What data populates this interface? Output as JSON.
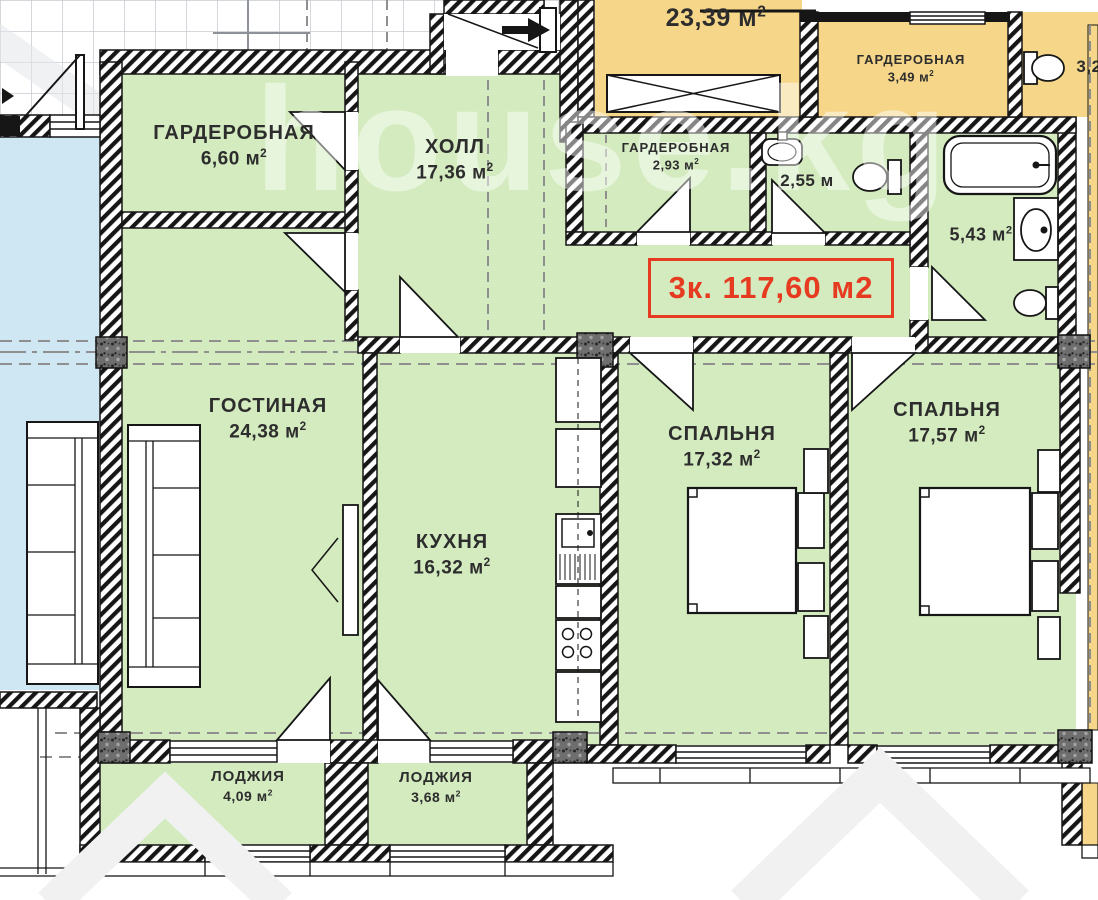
{
  "badge": {
    "text": "3к. 117,60 м2"
  },
  "watermark": "house.kg",
  "rooms": {
    "wardrobe1": {
      "name": "ГАРДЕРОБНАЯ",
      "area": "6,60 м",
      "sup": "2"
    },
    "hall": {
      "name": "ХОЛЛ",
      "area": "17,36 м",
      "sup": "2"
    },
    "wardrobe2": {
      "name": "ГАРДЕРОБНАЯ",
      "area": "2,93 м",
      "sup": "2"
    },
    "wc": {
      "area": "2,55 м"
    },
    "bathroom": {
      "area": "5,43 м",
      "sup": "2"
    },
    "living": {
      "name": "ГОСТИНАЯ",
      "area": "24,38 м",
      "sup": "2"
    },
    "kitchen": {
      "name": "КУХНЯ",
      "area": "16,32 м",
      "sup": "2"
    },
    "bedroom1": {
      "name": "СПАЛЬНЯ",
      "area": "17,32 м",
      "sup": "2"
    },
    "bedroom2": {
      "name": "СПАЛЬНЯ",
      "area": "17,57 м",
      "sup": "2"
    },
    "loggia1": {
      "name": "ЛОДЖИЯ",
      "area": "4,09 м",
      "sup": "2"
    },
    "loggia2": {
      "name": "ЛОДЖИЯ",
      "area": "3,68 м",
      "sup": "2"
    }
  },
  "neighbors": {
    "room": {
      "area": "23,39 м",
      "sup": "2"
    },
    "wardrobe": {
      "name": "ГАРДЕРОБНАЯ",
      "area": "3,49 м",
      "sup": "2"
    },
    "right": {
      "area": "3,2"
    }
  },
  "colors": {
    "room_green": "#d3ebbf",
    "neighbor_yellow": "#f6d78a",
    "neighbor_blue": "#cfe7f3",
    "accent_red": "#e63b20"
  }
}
